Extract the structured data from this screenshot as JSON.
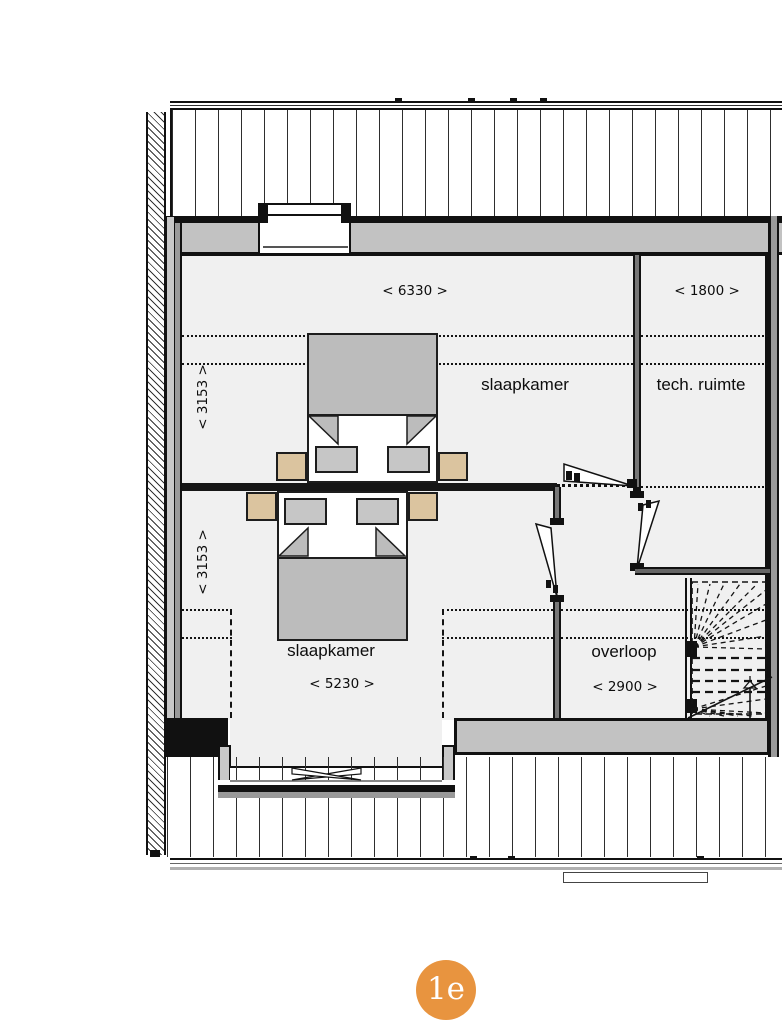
{
  "plan_title": "first-floor-plan",
  "badge": {
    "label": "1e",
    "color": "#e8943f"
  },
  "rooms": {
    "bedroom_top": {
      "label": "slaapkamer",
      "dim_width": "< 6330 >",
      "dim_depth": "< 3153 >"
    },
    "tech_room": {
      "label": "tech. ruimte",
      "dim_width": "< 1800 >"
    },
    "bedroom_bottom": {
      "label": "slaapkamer",
      "dim_width": "< 5230 >",
      "dim_depth": "< 3153 >"
    },
    "landing": {
      "label": "overloop",
      "dim_width": "< 2900 >"
    }
  },
  "colors": {
    "floor": "#f0f0f0",
    "wall_fill": "#c2c2c2",
    "wall_dark": "#9a9a9a",
    "outline": "#111111",
    "furniture_gray": "#bcbcbc",
    "nightstand_tan": "#dbc49f",
    "badge_orange": "#e8943f"
  }
}
